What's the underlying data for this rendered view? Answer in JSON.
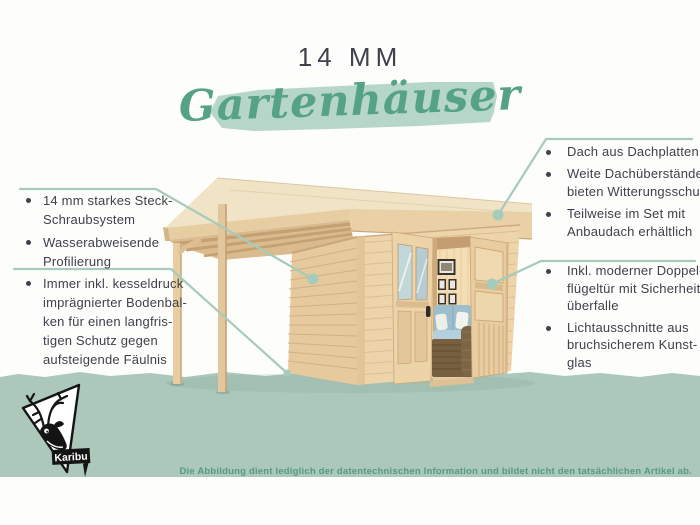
{
  "title": {
    "size_label": "14 MM",
    "script_label": "Gartenhäuser"
  },
  "left_panel": {
    "items": [
      {
        "lines": [
          "14 mm starkes Steck-",
          "Schraubsystem"
        ]
      },
      {
        "lines": [
          "Wasserabweisende",
          "Profilierung"
        ]
      },
      {
        "lines": [
          "Immer inkl. kesseldruck",
          "imprägnierter Bodenbal-",
          "ken für einen langfris-",
          "tigen Schutz gegen",
          "aufsteigende Fäulnis"
        ]
      }
    ]
  },
  "right_panel": {
    "items": [
      {
        "lines": [
          "Dach aus Dachplatten"
        ]
      },
      {
        "lines": [
          "Weite Dachüberstände",
          "bieten Witterungsschutz"
        ]
      },
      {
        "lines": [
          "Teilweise im Set mit",
          "Anbaudach erhältlich"
        ]
      },
      {
        "lines": [
          "Inkl. moderner Doppel-",
          "flügeltür mit Sicherheits-",
          "überfalle"
        ]
      },
      {
        "lines": [
          "Lichtausschnitte aus",
          "bruchsicherem Kunst-",
          "glas"
        ]
      }
    ]
  },
  "brand": {
    "logo_label": "Karibu"
  },
  "disclaimer": "Die Abbildung dient lediglich der datentechnischen Information und bildet nicht den tatsächlichen Artikel ab.",
  "colors": {
    "accent": "#a5cbba",
    "band": "#abc8ba",
    "brush": "#b6d6c8",
    "script_green": "#56a287",
    "text_dark": "#3f414b",
    "disclaimer_green": "#569a7f"
  }
}
